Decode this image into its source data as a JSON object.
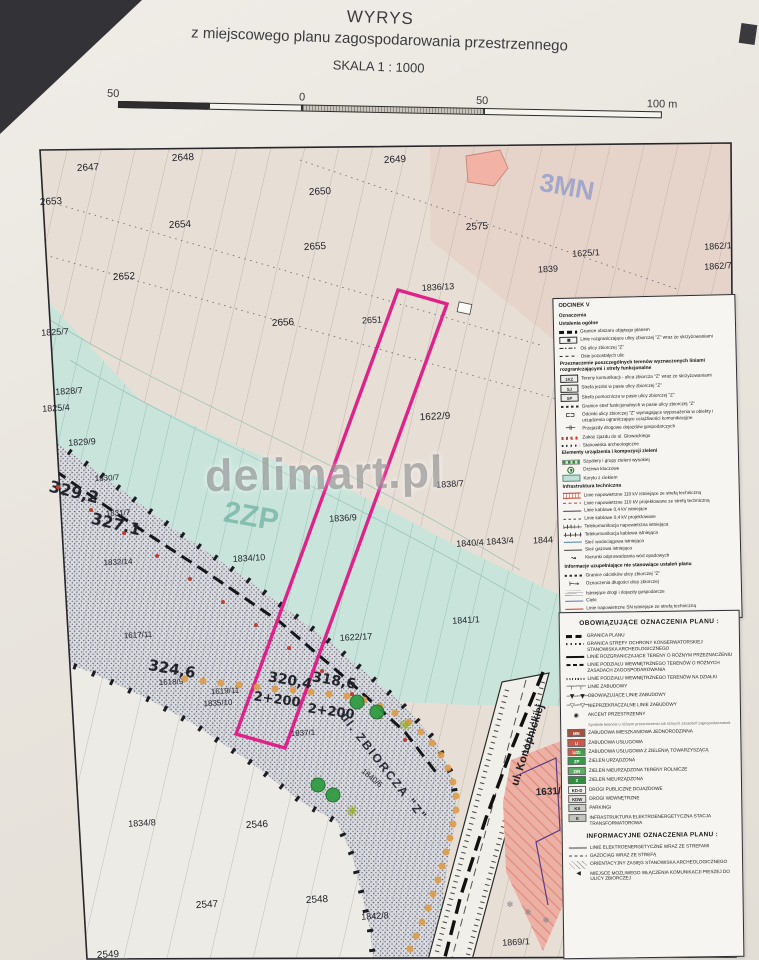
{
  "title": {
    "line1": "WYRYS",
    "line2": "z miejscowego planu zagospodarowania przestrzennego",
    "scale": "SKALA 1 : 1000"
  },
  "scalebar": {
    "left_label": "50",
    "zero_label": "0",
    "mid_label": "50",
    "right_label": "100 m"
  },
  "watermark": "delimart.pl",
  "colors": {
    "highlight_parcel_outline": "#e0218a",
    "teal_zone": "#c9e5db",
    "road_corridor": "#dadce2",
    "tree_row_dot": "#dd9a46",
    "key_tree": "#2c9a3e"
  },
  "map": {
    "zone_labels": [
      {
        "t": "3MN",
        "x": 567,
        "y": 187,
        "r": 10,
        "s": 26,
        "c": "#8d99c9",
        "w": 700,
        "o": 0.75
      },
      {
        "t": "2ZP",
        "x": 251,
        "y": 517,
        "r": 10,
        "s": 30,
        "c": "#76b5a6",
        "w": 700,
        "o": 0.8
      }
    ],
    "street_labels": [
      {
        "t": "ul. ZBIORCZA \"Z\"",
        "x": 384,
        "y": 767,
        "r": 52,
        "s": 12,
        "c": "#2e2e38",
        "w": 700,
        "ls": 2
      },
      {
        "t": "ul. Konopnickiej",
        "x": 528,
        "y": 745,
        "r": -72,
        "s": 11,
        "c": "#1d1d24",
        "w": 700
      }
    ],
    "chainage_labels": [
      {
        "t": "329,2",
        "x": 74,
        "y": 492,
        "r": 14,
        "s": 16,
        "w": 700
      },
      {
        "t": "327,1",
        "x": 116,
        "y": 524,
        "r": 14,
        "s": 16,
        "w": 700
      },
      {
        "t": "324,6",
        "x": 172,
        "y": 669,
        "r": 10,
        "s": 15,
        "w": 700
      },
      {
        "t": "320,4",
        "x": 290,
        "y": 681,
        "r": 10,
        "s": 14,
        "w": 700
      },
      {
        "t": "318,6",
        "x": 334,
        "y": 681,
        "r": 10,
        "s": 14,
        "w": 700
      },
      {
        "t": "2+200",
        "x": 277,
        "y": 700,
        "r": 8,
        "s": 13,
        "w": 700
      },
      {
        "t": "2+200",
        "x": 331,
        "y": 712,
        "r": 8,
        "s": 13,
        "w": 700
      }
    ],
    "parcel_labels": [
      {
        "t": "2647",
        "x": 88,
        "y": 168
      },
      {
        "t": "2648",
        "x": 183,
        "y": 158
      },
      {
        "t": "2650",
        "x": 320,
        "y": 192
      },
      {
        "t": "2653",
        "x": 51,
        "y": 202
      },
      {
        "t": "2654",
        "x": 180,
        "y": 225
      },
      {
        "t": "2655",
        "x": 315,
        "y": 247
      },
      {
        "t": "2652",
        "x": 124,
        "y": 277
      },
      {
        "t": "2656",
        "x": 283,
        "y": 323
      },
      {
        "t": "2649",
        "x": 395,
        "y": 160
      },
      {
        "t": "2575",
        "x": 477,
        "y": 227
      },
      {
        "t": "1625/1",
        "x": 586,
        "y": 253,
        "s": 9
      },
      {
        "t": "1839",
        "x": 548,
        "y": 269,
        "s": 9
      },
      {
        "t": "1862/1",
        "x": 718,
        "y": 246,
        "s": 9
      },
      {
        "t": "1862/7",
        "x": 718,
        "y": 266,
        "s": 9
      },
      {
        "t": "1836/13",
        "x": 438,
        "y": 287,
        "s": 9
      },
      {
        "t": "2651",
        "x": 372,
        "y": 320,
        "s": 9
      },
      {
        "t": "1825/7",
        "x": 55,
        "y": 332,
        "s": 9
      },
      {
        "t": "1828/7",
        "x": 69,
        "y": 391,
        "s": 9
      },
      {
        "t": "1825/4",
        "x": 56,
        "y": 408,
        "s": 9
      },
      {
        "t": "1829/9",
        "x": 82,
        "y": 442,
        "s": 9
      },
      {
        "t": "1830/7",
        "x": 107,
        "y": 478,
        "s": 8
      },
      {
        "t": "1831/7",
        "x": 118,
        "y": 513,
        "s": 8
      },
      {
        "t": "1832/14",
        "x": 118,
        "y": 562,
        "s": 8
      },
      {
        "t": "1834/10",
        "x": 249,
        "y": 558,
        "s": 9
      },
      {
        "t": "1617/11",
        "x": 138,
        "y": 635,
        "s": 8
      },
      {
        "t": "1618/9",
        "x": 171,
        "y": 682,
        "s": 8
      },
      {
        "t": "1619/11",
        "x": 225,
        "y": 691,
        "s": 8
      },
      {
        "t": "1835/10",
        "x": 218,
        "y": 703,
        "s": 8
      },
      {
        "t": "1837/1",
        "x": 303,
        "y": 733,
        "s": 8
      },
      {
        "t": "1622/9",
        "x": 435,
        "y": 417
      },
      {
        "t": "1838/7",
        "x": 450,
        "y": 484,
        "s": 9
      },
      {
        "t": "1836/9",
        "x": 343,
        "y": 518,
        "s": 9
      },
      {
        "t": "1840/4",
        "x": 470,
        "y": 543,
        "s": 9
      },
      {
        "t": "1843/4",
        "x": 500,
        "y": 541,
        "s": 9
      },
      {
        "t": "1844",
        "x": 543,
        "y": 540,
        "s": 9
      },
      {
        "t": "1841/1",
        "x": 466,
        "y": 620,
        "s": 9
      },
      {
        "t": "1622/17",
        "x": 356,
        "y": 637,
        "s": 9
      },
      {
        "t": "1840/6",
        "x": 372,
        "y": 778,
        "s": 8,
        "r": 40
      },
      {
        "t": "1834/8",
        "x": 142,
        "y": 823,
        "s": 9
      },
      {
        "t": "2546",
        "x": 257,
        "y": 825
      },
      {
        "t": "2547",
        "x": 207,
        "y": 905
      },
      {
        "t": "2548",
        "x": 317,
        "y": 900
      },
      {
        "t": "1842/8",
        "x": 375,
        "y": 916,
        "s": 9
      },
      {
        "t": "2549",
        "x": 108,
        "y": 955
      },
      {
        "t": "1869/1",
        "x": 516,
        "y": 942,
        "s": 9
      },
      {
        "t": "1631/6",
        "x": 551,
        "y": 792,
        "s": 10,
        "w": 700
      }
    ],
    "tree_row_dots": [
      [
        185,
        679
      ],
      [
        203,
        681
      ],
      [
        221,
        683
      ],
      [
        239,
        685
      ],
      [
        257,
        687
      ],
      [
        275,
        689
      ],
      [
        293,
        690
      ],
      [
        311,
        692
      ],
      [
        329,
        694
      ],
      [
        347,
        696
      ],
      [
        364,
        700
      ],
      [
        380,
        706
      ],
      [
        395,
        713
      ],
      [
        409,
        722
      ],
      [
        421,
        732
      ],
      [
        432,
        743
      ],
      [
        441,
        755
      ],
      [
        448,
        768
      ],
      [
        453,
        782
      ],
      [
        456,
        796
      ],
      [
        456,
        810
      ],
      [
        453,
        824
      ],
      [
        450,
        838
      ],
      [
        446,
        852
      ],
      [
        442,
        866
      ],
      [
        438,
        880
      ],
      [
        433,
        894
      ],
      [
        428,
        908
      ],
      [
        422,
        922
      ],
      [
        416,
        936
      ],
      [
        410,
        949
      ]
    ],
    "red_dots": [
      [
        58,
        487
      ],
      [
        91,
        510
      ],
      [
        124,
        533
      ],
      [
        157,
        556
      ],
      [
        190,
        579
      ],
      [
        223,
        602
      ],
      [
        256,
        625
      ],
      [
        289,
        648
      ],
      [
        322,
        671
      ],
      [
        352,
        694
      ],
      [
        380,
        717
      ],
      [
        405,
        740
      ]
    ],
    "key_trees": [
      [
        357,
        702
      ],
      [
        377,
        712
      ],
      [
        318,
        785
      ],
      [
        333,
        795
      ]
    ],
    "star_marks": [
      [
        405,
        726
      ],
      [
        352,
        812
      ]
    ],
    "x_marks": [
      [
        510,
        905
      ],
      [
        528,
        913
      ],
      [
        546,
        921
      ]
    ]
  },
  "legend_odcinek": {
    "title": "ODCINEK V",
    "subtitle": "Oznaczenia",
    "sections": [
      {
        "header": "Ustalenia ogólne",
        "items": [
          {
            "sw": "bdash",
            "label": "Granice obszaru objętego planem"
          },
          {
            "sw": "boxtick",
            "label": "Linie rozgraniczające ulicy zbiorczej \"Z\" wraz ze skrzyżowaniami"
          },
          {
            "sw": "dashdot",
            "label": "Oś ulicy zbiorczej \"Z\""
          },
          {
            "sw": "dash",
            "label": "Osie pozostałych ulic"
          }
        ]
      },
      {
        "header": "Przeznaczenie poszczególnych terenów wyznaczonych liniami rozgraniczającymi i strefy funkcjonalne",
        "items": [
          {
            "sw": "tagbox",
            "tag": "1KZ",
            "label": "Tereny komunikacji - ulica zbiorcza \"Z\" wraz ze skrzyżowaniami"
          },
          {
            "sw": "tagbox",
            "tag": "SJ",
            "label": "Strefa jezdni w pasie ulicy zbiorczej \"Z\""
          },
          {
            "sw": "tagbox",
            "tag": "SP",
            "label": "Strefa pomocnicza w pasie ulicy zbiorczej \"Z\""
          },
          {
            "sw": "fdash",
            "label": "Granice stref funkcjonalnych w pasie ulicy zbiorczej \"Z\""
          },
          {
            "sym": "⊏⊐",
            "label": "Odcinki ulicy zbiorczej \"Z\" wymagające wyposażenia w obiekty i urządzenia ograniczające uciążliwości komunikacyjne"
          },
          {
            "sym": "⊣⊢",
            "label": "Przejazdy drogowe dojazdów gospodarczych"
          },
          {
            "sw": "rdots",
            "label": "Zakaz zjazdu do ul. Głowackiego"
          },
          {
            "sw": "kdots",
            "label": "Stanowiska archeologiczne"
          }
        ]
      },
      {
        "header": "Elementy urządzenia i kompozycji zieleni",
        "items": [
          {
            "sw": "gdots",
            "label": "Szpalery i grupy zieleni wysokiej"
          },
          {
            "sw": "tree",
            "label": "Drzewa kluczowe"
          },
          {
            "sw": "tealbox",
            "label": "Koryto z ciekiem"
          }
        ]
      },
      {
        "header": "Infrastruktura techniczna",
        "items": [
          {
            "sw": "rhatch",
            "label": "Linie napowietrzne 110 kV istniejące ze strefą techniczną"
          },
          {
            "sw": "rdash",
            "label": "Linie napowietrzne 110 kV projektowane ze strefą techniczną"
          },
          {
            "sw": "thin",
            "label": "Linie kablowe 0,4 kV istniejące"
          },
          {
            "sw": "thindash",
            "label": "Linie kablowe 0,4 kV projektowane"
          },
          {
            "sw": "tick",
            "label": "Telekomunikacja napowietrzna istniejąca"
          },
          {
            "sw": "tick2",
            "label": "Telekomunikacja kablowa istniejąca"
          },
          {
            "sw": "blue",
            "label": "Sieć wodociągowa istniejąca"
          },
          {
            "sw": "thin",
            "label": "Sieć gazowa istniejąca"
          },
          {
            "sym": "↝",
            "label": "Kierunki odprowadzania wód opadowych"
          }
        ]
      },
      {
        "header": "Informacje uzupełniające nie stanowiące ustaleń planu",
        "items": [
          {
            "sw": "fdash",
            "label": "Granice odcinków ulicy zbiorczej \"Z\""
          },
          {
            "sym": "⊢→",
            "label": "Oznaczenia długości ulicy zbiorczej"
          },
          {
            "sw": "groad",
            "label": "Istniejące drogi i dojazdy gospodarcze"
          },
          {
            "sw": "blue",
            "label": "Cieki"
          },
          {
            "sw": "red",
            "label": "Linie napowietrzne SN istniejące ze strefą techniczną"
          }
        ]
      }
    ]
  },
  "legend_plan": {
    "header": "OBOWIĄZUJĄCE OZNACZENIA PLANU :",
    "items": [
      {
        "sw": "thick",
        "label": "GRANICA PLANU"
      },
      {
        "sw": "kdots",
        "label": "GRANICA STREFY OCHRONY KONSERWATORSKIEJ STANOWISKA ARCHEOLOGICZNEGO"
      },
      {
        "sw": "solid",
        "label": "LINIE ROZGRANICZAJĄCE TERENY O RÓŻNYM PRZEZNACZENIU"
      },
      {
        "sw": "mdash",
        "label": "LINIE PODZIAŁU WEWNĘTRZNEGO TERENÓW O RÓŻNYCH ZASADACH ZAGOSPODAROWANIA"
      },
      {
        "sw": "fdots",
        "label": "LINIE PODZIAŁU WEWNĘTRZNEGO TERENÓW NA DZIAŁKI"
      },
      {
        "sym": "─┬──┬─",
        "label": "LINIE ZABUDOWY"
      },
      {
        "sym": "─▼──▼─",
        "label": "OBOWIĄZUJĄCE LINIE ZABUDOWY"
      },
      {
        "sym": "─▽──▽─",
        "label": "NIEPRZEKRACZALNE LINIE ZABUDOWY"
      },
      {
        "sym": "◉",
        "label": "AKCENT PRZESTRZENNY"
      }
    ],
    "note": "Symbole terenów o różnym przeznaczeniu lub różnych zasadach zagospodarowania",
    "zones": [
      {
        "tag": "MN",
        "color": "#a94f3d",
        "text": "#fff",
        "label": "ZABUDOWA MIESZKANIOWA JEDNORODZINNA"
      },
      {
        "tag": "U",
        "color": "#cc5848",
        "text": "#fff",
        "label": "ZABUDOWA USŁUGOWA"
      },
      {
        "tag": "U/Zt",
        "color": "split",
        "text": "#fff",
        "label": "ZABUDOWA USŁUGOWA Z ZIELENIĄ TOWARZYSZĄCĄ"
      },
      {
        "tag": "ZP",
        "color": "#2f9e47",
        "text": "#fff",
        "label": "ZIELEŃ URZĄDZONA"
      },
      {
        "tag": "Z/R",
        "color": "#5fae68",
        "text": "#fff",
        "label": "ZIELEŃ NIEURZĄDZONA TERENY ROLNICZE"
      },
      {
        "tag": "Z",
        "color": "#2f8f3f",
        "text": "#fff",
        "label": "ZIELEŃ NIEURZĄDZONA"
      },
      {
        "tag": "KD-D",
        "color": "#f4f2ee",
        "text": "#222",
        "label": "DROGI PUBLICZNE DOJAZDOWE"
      },
      {
        "tag": "KDW",
        "color": "#e2e1dd",
        "text": "#222",
        "label": "DROGI WEWNĘTRZNE"
      },
      {
        "tag": "KS",
        "color": "#cbcbc7",
        "text": "#222",
        "label": "PARKINGI"
      },
      {
        "tag": "E",
        "color": "#c3c3bf",
        "text": "#222",
        "label": "INFRASTRUKTURA ELEKTROENERGETYCZNA STACJA TRANSFORMATOROWA"
      }
    ],
    "info_header": "INFORMACYJNE OZNACZENIA PLANU :",
    "info_items": [
      {
        "sw": "gline",
        "label": "LINIE ELEKTROENERGETYCZNE WRAZ ZE STREFAMI"
      },
      {
        "sw": "gdash",
        "label": "GAZOCIĄG WRAZ ZE STREFĄ"
      },
      {
        "sw": "ghatch",
        "label": "ORIENTACYJNY ZASIĘG STANOWISKA ARCHEOLOGICZNEGO"
      },
      {
        "sym": "◀",
        "label": "MIEJSCE MOŻLIWEGO WŁĄCZENIA KOMUNIKACJI PIESZEJ DO ULICY ZBIORCZEJ"
      }
    ]
  }
}
